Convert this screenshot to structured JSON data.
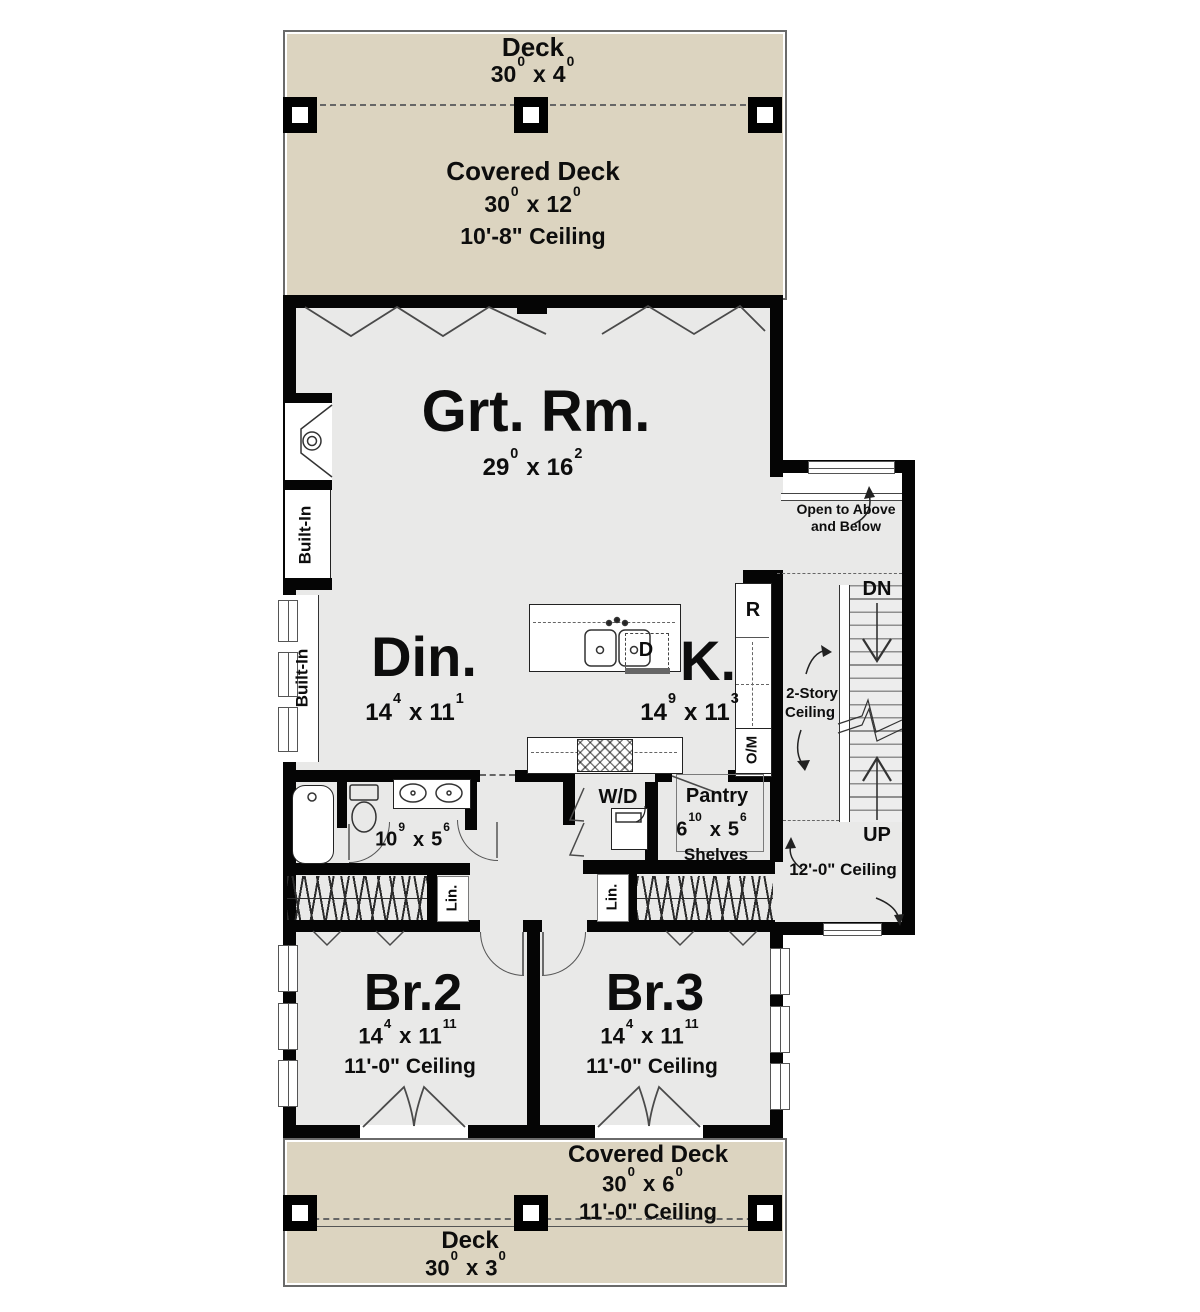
{
  "colors": {
    "deck_fill": "#dcd4c0",
    "floor_fill": "#e9e9e8",
    "wall": "#050505",
    "background": "#ffffff"
  },
  "sep": {
    "x": "x"
  },
  "top_deck": {
    "title": "Deck",
    "dim_a": "30",
    "sup_a": "0",
    "dim_b": "4",
    "sup_b": "0"
  },
  "top_covered_deck": {
    "title": "Covered Deck",
    "dim_a": "30",
    "sup_a": "0",
    "dim_b": "12",
    "sup_b": "0",
    "ceiling": "10'-8\" Ceiling"
  },
  "great_room": {
    "name": "Grt. Rm.",
    "dim_a": "29",
    "sup_a": "0",
    "dim_b": "16",
    "sup_b": "2"
  },
  "dining": {
    "name": "Din.",
    "dim_a": "14",
    "sup_a": "4",
    "dim_b": "11",
    "sup_b": "1"
  },
  "kitchen": {
    "name": "K.",
    "dim_a": "14",
    "sup_a": "9",
    "dim_b": "11",
    "sup_b": "3",
    "fridge": "R",
    "dishwasher": "D",
    "oven_microwave": "O/M"
  },
  "bath": {
    "dim_a": "10",
    "sup_a": "9",
    "dim_b": "5",
    "sup_b": "6"
  },
  "laundry": {
    "label": "W/D"
  },
  "pantry": {
    "name": "Pantry",
    "dim_a": "6",
    "sup_a": "10",
    "dim_b": "5",
    "sup_b": "6",
    "shelves": "Shelves"
  },
  "closets": {
    "lin_left": "Lin.",
    "lin_right": "Lin."
  },
  "built_ins": {
    "upper": "Built-In",
    "lower": "Built-In"
  },
  "stair": {
    "down": "DN",
    "up": "UP",
    "open_line1": "Open to Above",
    "open_line2": "and Below",
    "two_story_line1": "2-Story",
    "two_story_line2": "Ceiling",
    "ceiling": "12'-0\" Ceiling"
  },
  "bedroom2": {
    "name": "Br.2",
    "dim_a": "14",
    "sup_a": "4",
    "dim_b": "11",
    "sup_b": "11",
    "ceiling": "11'-0\" Ceiling"
  },
  "bedroom3": {
    "name": "Br.3",
    "dim_a": "14",
    "sup_a": "4",
    "dim_b": "11",
    "sup_b": "11",
    "ceiling": "11'-0\" Ceiling"
  },
  "bottom_covered_deck": {
    "title": "Covered Deck",
    "dim_a": "30",
    "sup_a": "0",
    "dim_b": "6",
    "sup_b": "0",
    "ceiling": "11'-0\" Ceiling"
  },
  "bottom_deck": {
    "title": "Deck",
    "dim_a": "30",
    "sup_a": "0",
    "dim_b": "3",
    "sup_b": "0"
  }
}
